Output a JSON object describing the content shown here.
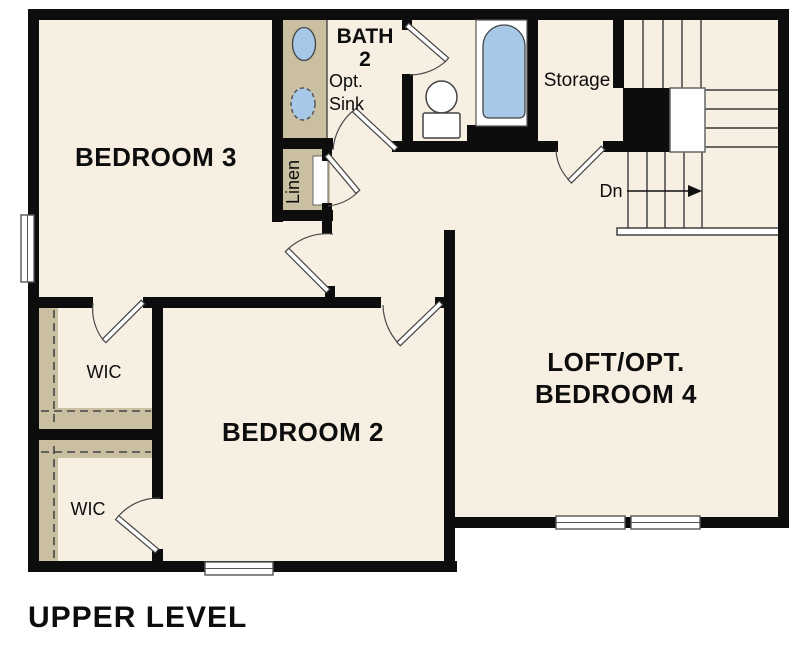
{
  "title": "UPPER LEVEL",
  "colors": {
    "floor": "#f7efe2",
    "cabinet_tan": "#cbbfa2",
    "fixture_blue": "#a7c8e6",
    "wall": "#0d0d0d"
  },
  "rooms": {
    "bedroom3": {
      "label": "BEDROOM 3"
    },
    "bath2": {
      "line1": "BATH",
      "line2": "2"
    },
    "opt_sink": {
      "line1": "Opt.",
      "line2": "Sink"
    },
    "storage": {
      "label": "Storage"
    },
    "linen": {
      "label": "Linen"
    },
    "wic_upper": {
      "label": "WIC"
    },
    "wic_lower": {
      "label": "WIC"
    },
    "bedroom2": {
      "label": "BEDROOM 2"
    },
    "loft": {
      "line1": "LOFT/OPT.",
      "line2": "BEDROOM 4"
    }
  },
  "stairs": {
    "down_label": "Dn"
  }
}
